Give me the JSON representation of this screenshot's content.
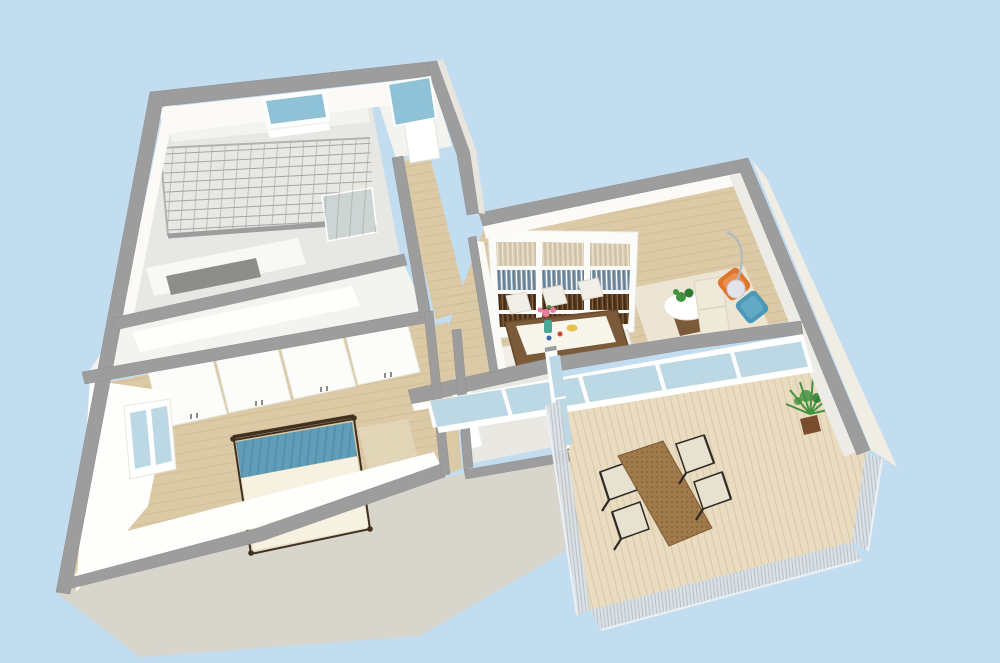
{
  "scene": {
    "type": "3d-floor-plan-render",
    "rooms": [
      {
        "name": "glass-roof-room"
      },
      {
        "name": "utility-room"
      },
      {
        "name": "hallway"
      },
      {
        "name": "bedroom"
      },
      {
        "name": "bathroom"
      },
      {
        "name": "living-dining-room"
      },
      {
        "name": "balcony"
      }
    ],
    "furniture": [
      "bookshelf",
      "dining-table",
      "dining-chairs",
      "round-side-table",
      "sofa",
      "orange-armchair",
      "blue-armchair",
      "arc-floor-lamp",
      "double-bed",
      "wardrobes",
      "kitchen-counter",
      "outdoor-dining-set",
      "potted-plant",
      "mesh-railing"
    ]
  },
  "colors": {
    "background": "#c3ddf0",
    "wall": "#9d9d9d",
    "wallStroke": "#8f8f8f",
    "wallFaceLight": "#fbfaf7",
    "wallFaceBright": "#fefefc",
    "wallFaceShade": "#ecebe5",
    "exteriorFace": "#f0ede4",
    "exteriorFaceDim": "#e7e5dd",
    "plinth": "#d8d6cc",
    "floorLight": "#e7e7e3",
    "floorBright": "#f3f3ef",
    "white": "#ffffff",
    "wood": "#dcc9a6",
    "woodSeam": "#c9b28c",
    "deck": "#e9dcc0",
    "deckSeam": "#d4c19e",
    "glass": "#bcd8e5",
    "glassTeal": "#8fc2d6",
    "windowFrame": "#ffffff",
    "gridLine": "#a5a5a3",
    "gridEdge": "#b2b2b0",
    "gridPanel": "#ccd5d3",
    "railing": "#dce1e5",
    "railingLine": "#a9b3bb",
    "railingEdge": "#edf0f2",
    "shelfWhite": "#fbfbf9",
    "shelfEdge": "#e9e9e3",
    "booksTan": "#d8ccb2",
    "booksTanLineA": "#c9bca0",
    "booksTanLineB": "#efe8d8",
    "booksBlue": "#8198ab",
    "booksBlueLineA": "#ffffff",
    "booksBlueLineB": "#5a7184",
    "booksBrown": "#57391f",
    "booksBrownLineA": "#8a6a45",
    "booksBrownLineB": "#3c2410",
    "tableBrown": "#7b5a3a",
    "tableEdge": "#66482a",
    "runner": "#f7f5ec",
    "chairWhite": "#f1efe7",
    "chairEdge": "#dbd8cc",
    "rug": "#ece5d3",
    "sofa": "#efe9d9",
    "sofaEdge": "#ded5bd",
    "orangeChair": "#e0762e",
    "orangeCushion": "#ec9654",
    "blueChair": "#4b98b9",
    "blueCushion": "#6cb0ca",
    "lampMetal": "#b4b8bf",
    "lampGlobe": "#e3e4eb",
    "lampGlobeEdge": "#c9c9d6",
    "plantGreen": "#44923f",
    "plantDark": "#2f7a33",
    "plantPot": "#7a4c2e",
    "bedBlanket": "#5f9db8",
    "bedPleat": "#4c86a3",
    "bedDuvet": "#f6f1e0",
    "bedDuvetEdge": "#e6dcc4",
    "bedFrame": "#40301f",
    "wardrobe": "#fcfcfa",
    "wardrobeEdge": "#e6e6de",
    "handle": "#666660",
    "counterWhite": "#f8f8f5",
    "counterDark": "#8d8d8b",
    "outdoorTable": "#a17a4b",
    "outdoorSlat": "#7c5c36",
    "outdoorChairFrame": "#2e2b27",
    "outdoorSeat": "#e7e1d0",
    "vaseTeal": "#4aa896",
    "flowerPink": "#e87c9c",
    "bowlYellow": "#e8c24a",
    "dotRed": "#cf4426",
    "dotBlue": "#3a6ab8",
    "sideRug": "#e6dcc0",
    "bathFloor": "#e9e8e3"
  }
}
